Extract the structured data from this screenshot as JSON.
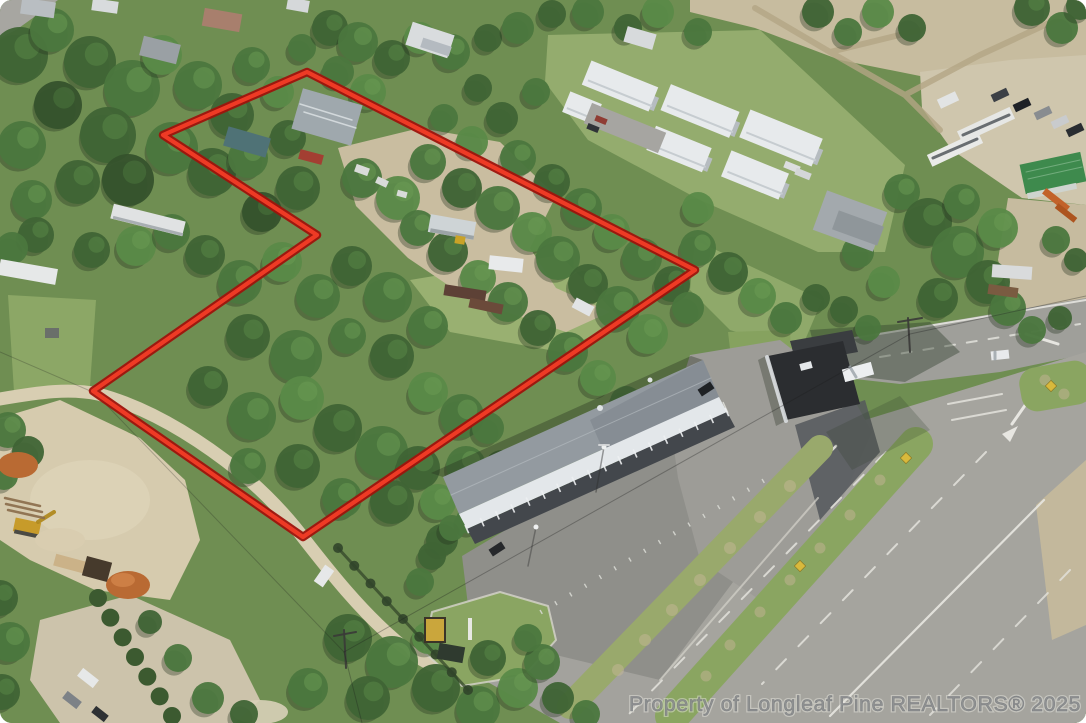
{
  "watermark": {
    "text": "Property of Longleaf Pine REALTORS® 2025",
    "color": "#87898c"
  },
  "boundary": {
    "label": "outlined property boundary",
    "points": "307,72 695,270 303,537 93,391 317,235 163,135",
    "outer_color": "#9e130c",
    "inner_color": "#ee3a25"
  }
}
